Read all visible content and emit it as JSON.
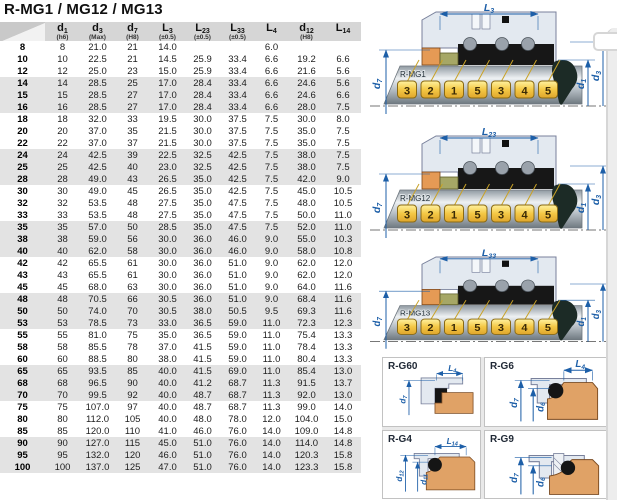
{
  "title": "R-MG1 / MG12 / MG13",
  "table": {
    "columns": [
      {
        "letter": "d",
        "sub": "1",
        "note": "(h6)"
      },
      {
        "letter": "d",
        "sub": "3",
        "note": "(Max)"
      },
      {
        "letter": "d",
        "sub": "7",
        "note": "(H8)"
      },
      {
        "letter": "L",
        "sub": "3",
        "note": "(±0.5)"
      },
      {
        "letter": "L",
        "sub": "23",
        "note": "(±0.5)"
      },
      {
        "letter": "L",
        "sub": "33",
        "note": "(±0.5)"
      },
      {
        "letter": "L",
        "sub": "4",
        "note": ""
      },
      {
        "letter": "d",
        "sub": "12",
        "note": "(H8)"
      },
      {
        "letter": "L",
        "sub": "14",
        "note": ""
      }
    ],
    "rows": [
      [
        "8",
        "8",
        "21.0",
        "21",
        "14.0",
        "",
        "",
        "6.0",
        "",
        ""
      ],
      [
        "10",
        "10",
        "22.5",
        "21",
        "14.5",
        "25.9",
        "33.4",
        "6.6",
        "19.2",
        "6.6"
      ],
      [
        "12",
        "12",
        "25.0",
        "23",
        "15.0",
        "25.9",
        "33.4",
        "6.6",
        "21.6",
        "5.6"
      ],
      [
        "14",
        "14",
        "28.5",
        "25",
        "17.0",
        "28.4",
        "33.4",
        "6.6",
        "24.6",
        "5.6"
      ],
      [
        "15",
        "15",
        "28.5",
        "27",
        "17.0",
        "28.4",
        "33.4",
        "6.6",
        "24.6",
        "6.6"
      ],
      [
        "16",
        "16",
        "28.5",
        "27",
        "17.0",
        "28.4",
        "33.4",
        "6.6",
        "28.0",
        "7.5"
      ],
      [
        "18",
        "18",
        "32.0",
        "33",
        "19.5",
        "30.0",
        "37.5",
        "7.5",
        "30.0",
        "8.0"
      ],
      [
        "20",
        "20",
        "37.0",
        "35",
        "21.5",
        "30.0",
        "37.5",
        "7.5",
        "35.0",
        "7.5"
      ],
      [
        "22",
        "22",
        "37.0",
        "37",
        "21.5",
        "30.0",
        "37.5",
        "7.5",
        "35.0",
        "7.5"
      ],
      [
        "24",
        "24",
        "42.5",
        "39",
        "22.5",
        "32.5",
        "42.5",
        "7.5",
        "38.0",
        "7.5"
      ],
      [
        "25",
        "25",
        "42.5",
        "40",
        "23.0",
        "32.5",
        "42.5",
        "7.5",
        "38.0",
        "7.5"
      ],
      [
        "28",
        "28",
        "49.0",
        "43",
        "26.5",
        "35.0",
        "42.5",
        "7.5",
        "42.0",
        "9.0"
      ],
      [
        "30",
        "30",
        "49.0",
        "45",
        "26.5",
        "35.0",
        "42.5",
        "7.5",
        "45.0",
        "10.5"
      ],
      [
        "32",
        "32",
        "53.5",
        "48",
        "27.5",
        "35.0",
        "47.5",
        "7.5",
        "48.0",
        "10.5"
      ],
      [
        "33",
        "33",
        "53.5",
        "48",
        "27.5",
        "35.0",
        "47.5",
        "7.5",
        "50.0",
        "11.0"
      ],
      [
        "35",
        "35",
        "57.0",
        "50",
        "28.5",
        "35.0",
        "47.5",
        "7.5",
        "52.0",
        "11.0"
      ],
      [
        "38",
        "38",
        "59.0",
        "56",
        "30.0",
        "36.0",
        "46.0",
        "9.0",
        "55.0",
        "10.3"
      ],
      [
        "40",
        "40",
        "62.0",
        "58",
        "30.0",
        "36.0",
        "46.0",
        "9.0",
        "58.0",
        "10.8"
      ],
      [
        "42",
        "42",
        "65.5",
        "61",
        "30.0",
        "36.0",
        "51.0",
        "9.0",
        "62.0",
        "12.0"
      ],
      [
        "43",
        "43",
        "65.5",
        "61",
        "30.0",
        "36.0",
        "51.0",
        "9.0",
        "62.0",
        "12.0"
      ],
      [
        "45",
        "45",
        "68.0",
        "63",
        "30.0",
        "36.0",
        "51.0",
        "9.0",
        "64.0",
        "11.6"
      ],
      [
        "48",
        "48",
        "70.5",
        "66",
        "30.5",
        "36.0",
        "51.0",
        "9.0",
        "68.4",
        "11.6"
      ],
      [
        "50",
        "50",
        "74.0",
        "70",
        "30.5",
        "38.0",
        "50.5",
        "9.5",
        "69.3",
        "11.6"
      ],
      [
        "53",
        "53",
        "78.5",
        "73",
        "33.0",
        "36.5",
        "59.0",
        "11.0",
        "72.3",
        "12.3"
      ],
      [
        "55",
        "55",
        "81.0",
        "75",
        "35.0",
        "36.5",
        "59.0",
        "11.0",
        "75.4",
        "13.3"
      ],
      [
        "58",
        "58",
        "85.5",
        "78",
        "37.0",
        "41.5",
        "59.0",
        "11.0",
        "78.4",
        "13.3"
      ],
      [
        "60",
        "60",
        "88.5",
        "80",
        "38.0",
        "41.5",
        "59.0",
        "11.0",
        "80.4",
        "13.3"
      ],
      [
        "65",
        "65",
        "93.5",
        "85",
        "40.0",
        "41.5",
        "69.0",
        "11.0",
        "85.4",
        "13.0"
      ],
      [
        "68",
        "68",
        "96.5",
        "90",
        "40.0",
        "41.2",
        "68.7",
        "11.3",
        "91.5",
        "13.7"
      ],
      [
        "70",
        "70",
        "99.5",
        "92",
        "40.0",
        "48.7",
        "68.7",
        "11.3",
        "92.0",
        "13.0"
      ],
      [
        "75",
        "75",
        "107.0",
        "97",
        "40.0",
        "48.7",
        "68.7",
        "11.3",
        "99.0",
        "14.0"
      ],
      [
        "80",
        "80",
        "112.0",
        "105",
        "40.0",
        "48.0",
        "78.0",
        "12.0",
        "104.0",
        "15.0"
      ],
      [
        "85",
        "85",
        "120.0",
        "110",
        "41.0",
        "46.0",
        "76.0",
        "14.0",
        "109.0",
        "14.8"
      ],
      [
        "90",
        "90",
        "127.0",
        "115",
        "45.0",
        "51.0",
        "76.0",
        "14.0",
        "114.0",
        "14.8"
      ],
      [
        "95",
        "95",
        "132.0",
        "120",
        "46.0",
        "51.0",
        "76.0",
        "14.0",
        "120.3",
        "15.8"
      ],
      [
        "100",
        "100",
        "137.0",
        "125",
        "47.0",
        "51.0",
        "76.0",
        "14.0",
        "123.3",
        "15.8"
      ]
    ]
  },
  "seal_diagrams": [
    {
      "name": "R-MG1",
      "top_dim": {
        "letter": "L",
        "sub": "3"
      },
      "left_dim": {
        "letter": "d",
        "sub": "7"
      },
      "right_dim_inner": {
        "letter": "d",
        "sub": "1"
      },
      "right_dim_outer": {
        "letter": "d",
        "sub": "3"
      },
      "tags": [
        "3",
        "2",
        "1",
        "5",
        "3",
        "4",
        "5"
      ]
    },
    {
      "name": "R-MG12",
      "top_dim": {
        "letter": "L",
        "sub": "23"
      },
      "left_dim": {
        "letter": "d",
        "sub": "7"
      },
      "right_dim_inner": {
        "letter": "d",
        "sub": "1"
      },
      "right_dim_outer": {
        "letter": "d",
        "sub": "3"
      },
      "tags": [
        "3",
        "2",
        "1",
        "5",
        "3",
        "4",
        "5"
      ]
    },
    {
      "name": "R-MG13",
      "top_dim": {
        "letter": "L",
        "sub": "33"
      },
      "left_dim": {
        "letter": "d",
        "sub": "7"
      },
      "right_dim_inner": {
        "letter": "d",
        "sub": "1"
      },
      "right_dim_outer": {
        "letter": "d",
        "sub": "3"
      },
      "tags": [
        "3",
        "2",
        "1",
        "5",
        "3",
        "4",
        "5"
      ]
    }
  ],
  "seat_diagrams": [
    {
      "name": "R-G60",
      "top_dim": {
        "letter": "L",
        "sub": "4"
      },
      "left_dim1": {
        "letter": "d",
        "sub": "7"
      },
      "left_dim2": null
    },
    {
      "name": "R-G6",
      "top_dim": {
        "letter": "L",
        "sub": "4"
      },
      "left_dim1": {
        "letter": "d",
        "sub": "7"
      },
      "left_dim2": {
        "letter": "d",
        "sub": "6"
      }
    },
    {
      "name": "R-G4",
      "top_dim": {
        "letter": "L",
        "sub": "14"
      },
      "left_dim1": {
        "letter": "d",
        "sub": "12"
      },
      "left_dim2": {
        "letter": "d",
        "sub": "11"
      }
    },
    {
      "name": "R-G9",
      "top_dim": null,
      "left_dim1": {
        "letter": "d",
        "sub": "7"
      },
      "left_dim2": {
        "letter": "d",
        "sub": "6"
      }
    }
  ],
  "colors": {
    "dimension_blue": "#1d5fa8",
    "tag_yellow": "#f2c23a",
    "seat_tan": "#e0a266",
    "housing_blue_gray": "#e3e9f0",
    "header_gray": "#d6d6d6",
    "stripe_gray": "#e3e3e3"
  }
}
